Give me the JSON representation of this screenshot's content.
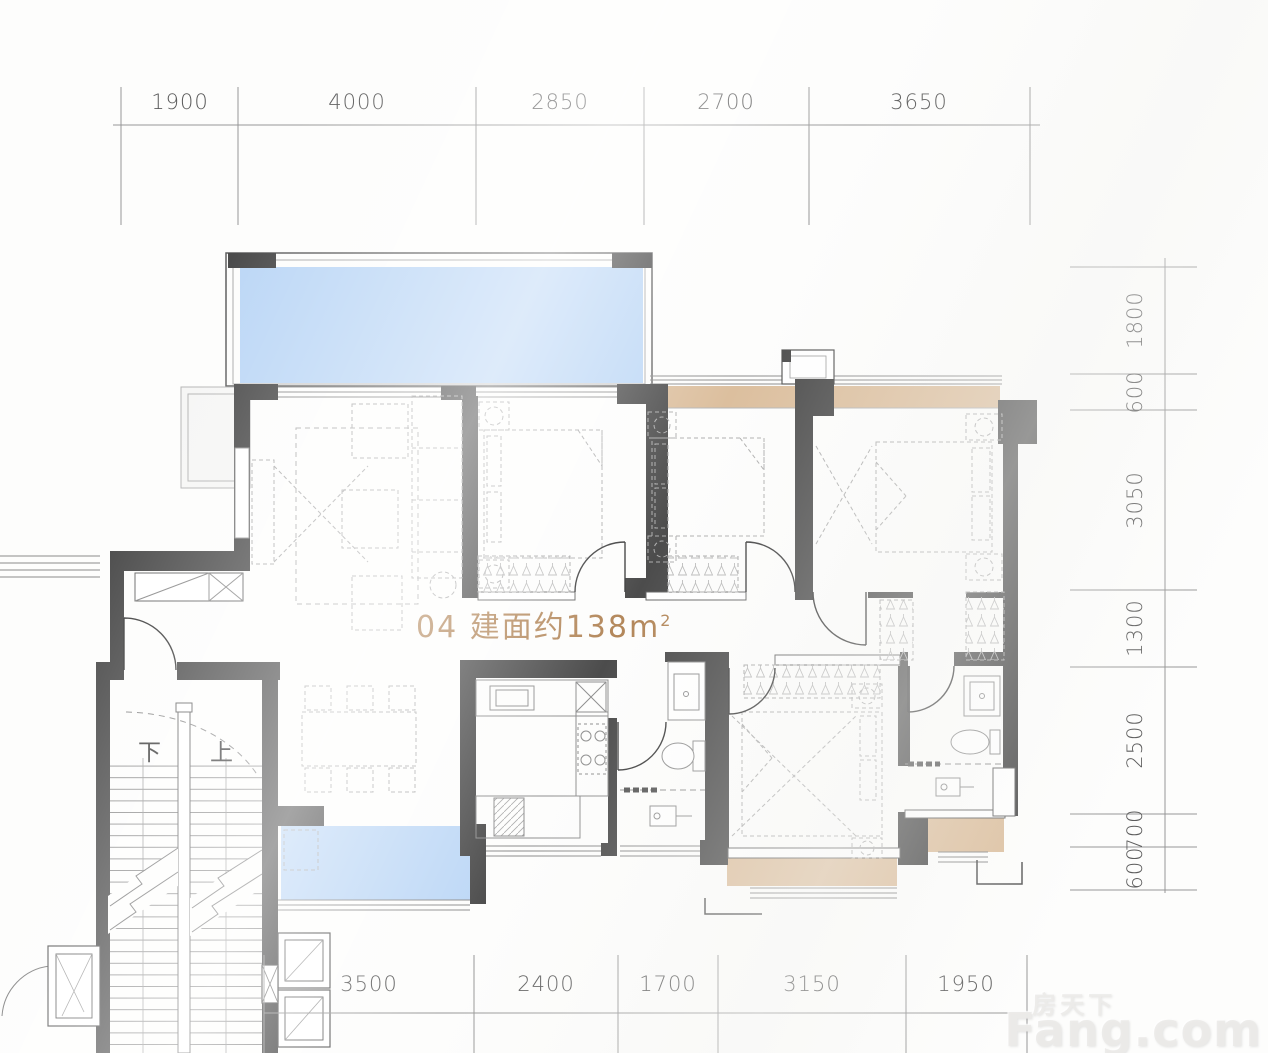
{
  "unit_label": {
    "text": "04 建面约138m",
    "sup": "2"
  },
  "dimensions": {
    "top": [
      "1900",
      "4000",
      "2850",
      "2700",
      "3650"
    ],
    "right": [
      "1800",
      "600",
      "3050",
      "1300",
      "2500",
      "700",
      "600"
    ],
    "bottom": [
      "3500",
      "2400",
      "1700",
      "3150",
      "1950"
    ]
  },
  "stairs": {
    "down": "下",
    "up": "上"
  },
  "watermark": {
    "cn": "房天下",
    "brand": "Fang.com"
  },
  "colors": {
    "wall": "#4c4c4c",
    "glass_blue": "#bcd7f6",
    "balcony_tan": "#dcbf9e",
    "unit_label": "#b3875a",
    "dimension_text": "#5c5c5c"
  }
}
